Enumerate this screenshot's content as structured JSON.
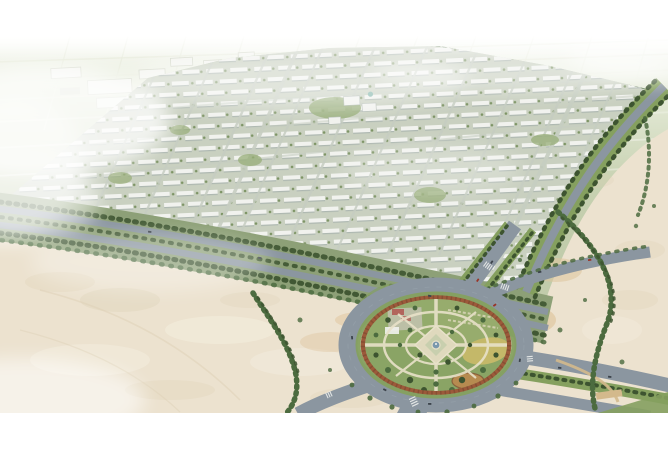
{
  "scene": {
    "type": "aerial-architectural-rendering",
    "description": "Aerial rendering of a residential master-planned compound: dense rows of white villas on a green grid, tree-lined perimeter boulevards, surrounding desert sand, and a large circular roundabout park with formal gardens and a central fountain",
    "elements": {
      "development": "villa-row-grid",
      "roundabout": "landscaped-garden-circle",
      "surroundings": "desert-sand-with-tree-lines",
      "background": "agricultural-field-grid"
    }
  },
  "palette": {
    "page_bg": "#ffffff",
    "fields_light": "#fbfcf8",
    "fields_mid": "#e2e8d4",
    "fields_green": "#c8d2b2",
    "fields_deep": "#c1ccab",
    "grid_line": "#eaeddf",
    "plot_white": "#f5f6f1",
    "plot_gray": "#d3d7c9",
    "dev_base": "#c9d0c0",
    "building_white": "#f1f2ee",
    "building_shadow": "#aeb8b1",
    "street": "#c6cdc1",
    "dev_tree": "#7d9465",
    "park_blob": "#97ad78",
    "dome_teal": "#7fb3a8",
    "boulevard_green": "#8da077",
    "strip_green": "#85a05f",
    "tree_dark": "#3d5430",
    "tree_mid": "#4c6b3f",
    "asphalt": "#8b96a0",
    "asphalt_light": "#9aa5ae",
    "sand": "#ece2cf",
    "sand_dark": "#ddd0b5",
    "sand_light": "#f4eedf",
    "sand_warm": "#dfc49c",
    "tan_edge": "#d3b98c",
    "park_green": "#8aa465",
    "lawn": "#9cb172",
    "lawn_right": "#a3b274",
    "plaza": "#bcbfa6",
    "pavilion_pink": "#b2655c",
    "flower_ring": "#9c5a3a",
    "flower_ring_dark": "#7e4a30",
    "path_cream": "#e8e1c9",
    "parterre": "#dfd9bd",
    "parterre_inner": "#c8cfae",
    "fountain_blue": "#7a98ac",
    "pergola_dark": "#3a3f36",
    "flower_yellow": "#c4b869",
    "flower_orange": "#b68b50",
    "car_dark": "#3c434b",
    "car_red": "#993326",
    "crosswalk": "#f2f3f0",
    "haze_white": "#ffffff"
  }
}
